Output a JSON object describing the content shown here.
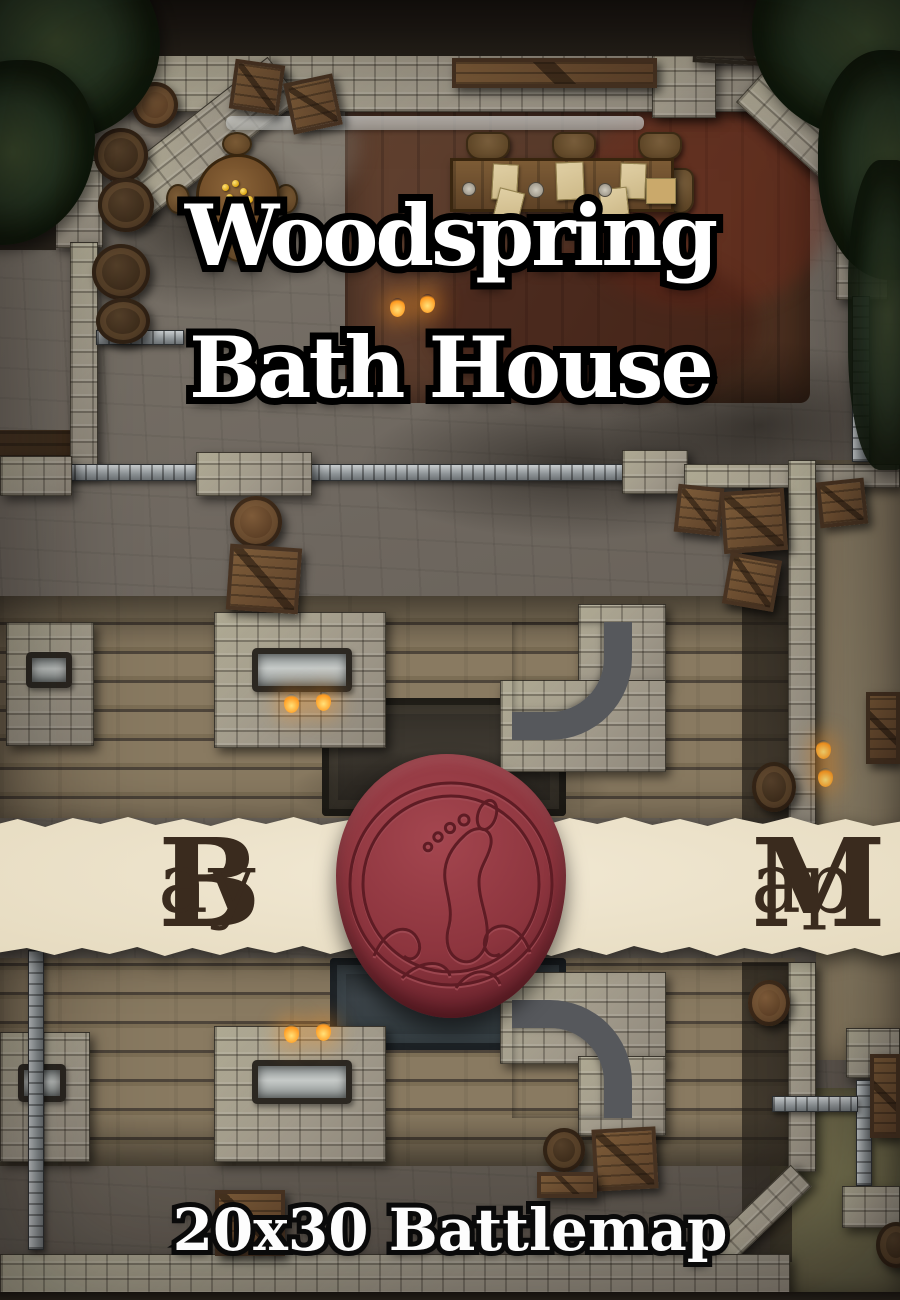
{
  "cover": {
    "title": {
      "line1": "Woodspring",
      "line2": "Bath House"
    },
    "brand": {
      "left": {
        "initial": "B",
        "rest": "ay"
      },
      "right": {
        "initial": "M",
        "rest": "ap"
      }
    },
    "footer": {
      "label": "20x30 Battlemap"
    },
    "seal": {
      "symbol": "footprint",
      "color": "#8d353e"
    },
    "banner": {
      "color": "#e7dcc2"
    },
    "colors": {
      "title_fill": "#ffffff",
      "title_outline": "#000000",
      "brand_text": "#3a2b1e",
      "footer_fill": "#ffffff",
      "parchment": "#e7dcc2",
      "seal_red": "#8d353e"
    }
  }
}
